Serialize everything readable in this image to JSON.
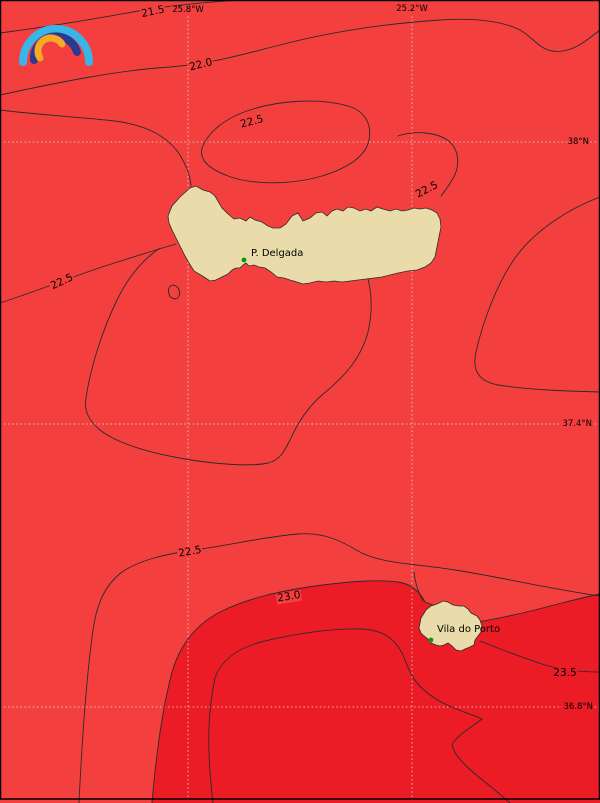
{
  "map": {
    "title": "Sea surface temperature contour map, Azores region",
    "colors": {
      "ocean": "#f3403f",
      "ocean_warm": "#ec1c26",
      "land": "#e9dcaa",
      "contour_line": "#2b2b2b",
      "gridline": "#d8cdc8",
      "frame": "#000000",
      "city_marker": "#0a9a0a",
      "logo_cyan": "#3ab5e8",
      "logo_blue": "#2b3a8f",
      "logo_orange": "#f9a825"
    },
    "grid": {
      "lon_labels": [
        {
          "text": "25.8°W",
          "x": 188,
          "y": 10
        },
        {
          "text": "25.2°W",
          "x": 412,
          "y": 9
        }
      ],
      "lat_labels": [
        {
          "text": "38°N",
          "y": 142,
          "on_warm_fill": false
        },
        {
          "text": "37.4°N",
          "y": 424,
          "on_warm_fill": false
        },
        {
          "text": "36.8°N",
          "y": 707,
          "on_warm_fill": true
        }
      ]
    },
    "isotherm_values": [
      21.5,
      22.0,
      22.5,
      23.0,
      23.5
    ],
    "contour_labels": [
      {
        "text": "21.5",
        "x": 153,
        "y": 12,
        "rot": -12,
        "dark": false
      },
      {
        "text": "22.0",
        "x": 201,
        "y": 65,
        "rot": -14,
        "dark": false
      },
      {
        "text": "22.5",
        "x": 252,
        "y": 122,
        "rot": -15,
        "dark": false
      },
      {
        "text": "22.5",
        "x": 427,
        "y": 190,
        "rot": -28,
        "dark": false
      },
      {
        "text": "22.5",
        "x": 62,
        "y": 282,
        "rot": -25,
        "dark": false
      },
      {
        "text": "22.5",
        "x": 190,
        "y": 552,
        "rot": -10,
        "dark": false
      },
      {
        "text": "23.0",
        "x": 289,
        "y": 597,
        "rot": -9,
        "dark": false
      },
      {
        "text": "23.5",
        "x": 565,
        "y": 673,
        "rot": 0,
        "dark": true
      }
    ],
    "places": [
      {
        "name": "P. Delgada",
        "marker_x": 244,
        "marker_y": 260,
        "label_x": 251,
        "label_y": 249
      },
      {
        "name": "Vila do Porto",
        "marker_x": 431,
        "marker_y": 640,
        "label_x": 437,
        "label_y": 625
      }
    ]
  }
}
